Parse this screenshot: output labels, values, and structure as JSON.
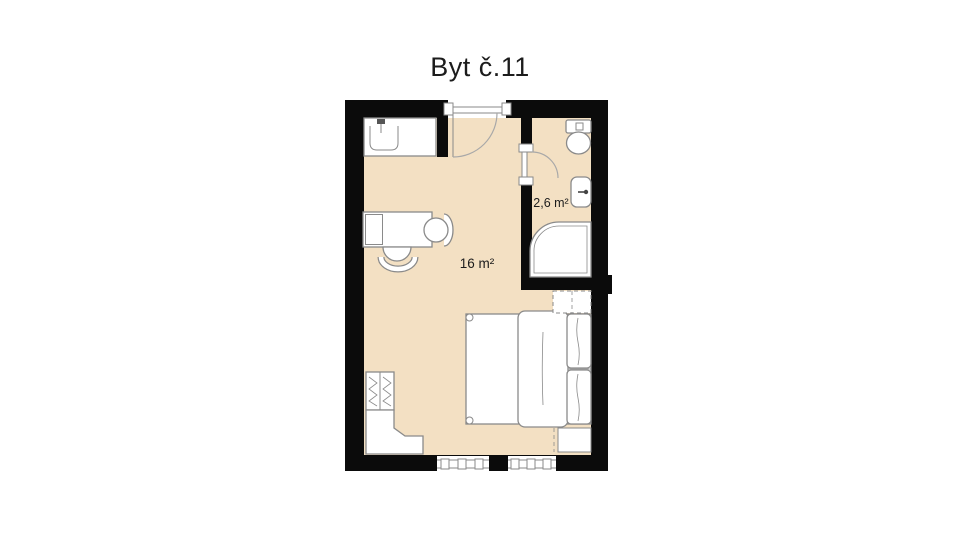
{
  "title": "Byt č.11",
  "rooms": {
    "main": {
      "area_label": "16 m²"
    },
    "bathroom": {
      "area_label": "2,6 m²"
    }
  },
  "colors": {
    "floor": "#f3e0c3",
    "wall": "#0b0b0b",
    "furniture_outline": "#8a8a8a",
    "door_arc": "#a8a8a8",
    "text": "#1c1c1c",
    "background": "#ffffff"
  },
  "fixtures": [
    "kitchen-sink-counter",
    "entry-door",
    "desk",
    "office-chair",
    "chair",
    "small-wardrobe",
    "corner-counter",
    "double-bed",
    "duvet",
    "pillows",
    "built-in-wardrobe",
    "bedside-cabinet",
    "bathroom-door",
    "toilet",
    "washbasin",
    "shower",
    "window-left",
    "window-right"
  ]
}
